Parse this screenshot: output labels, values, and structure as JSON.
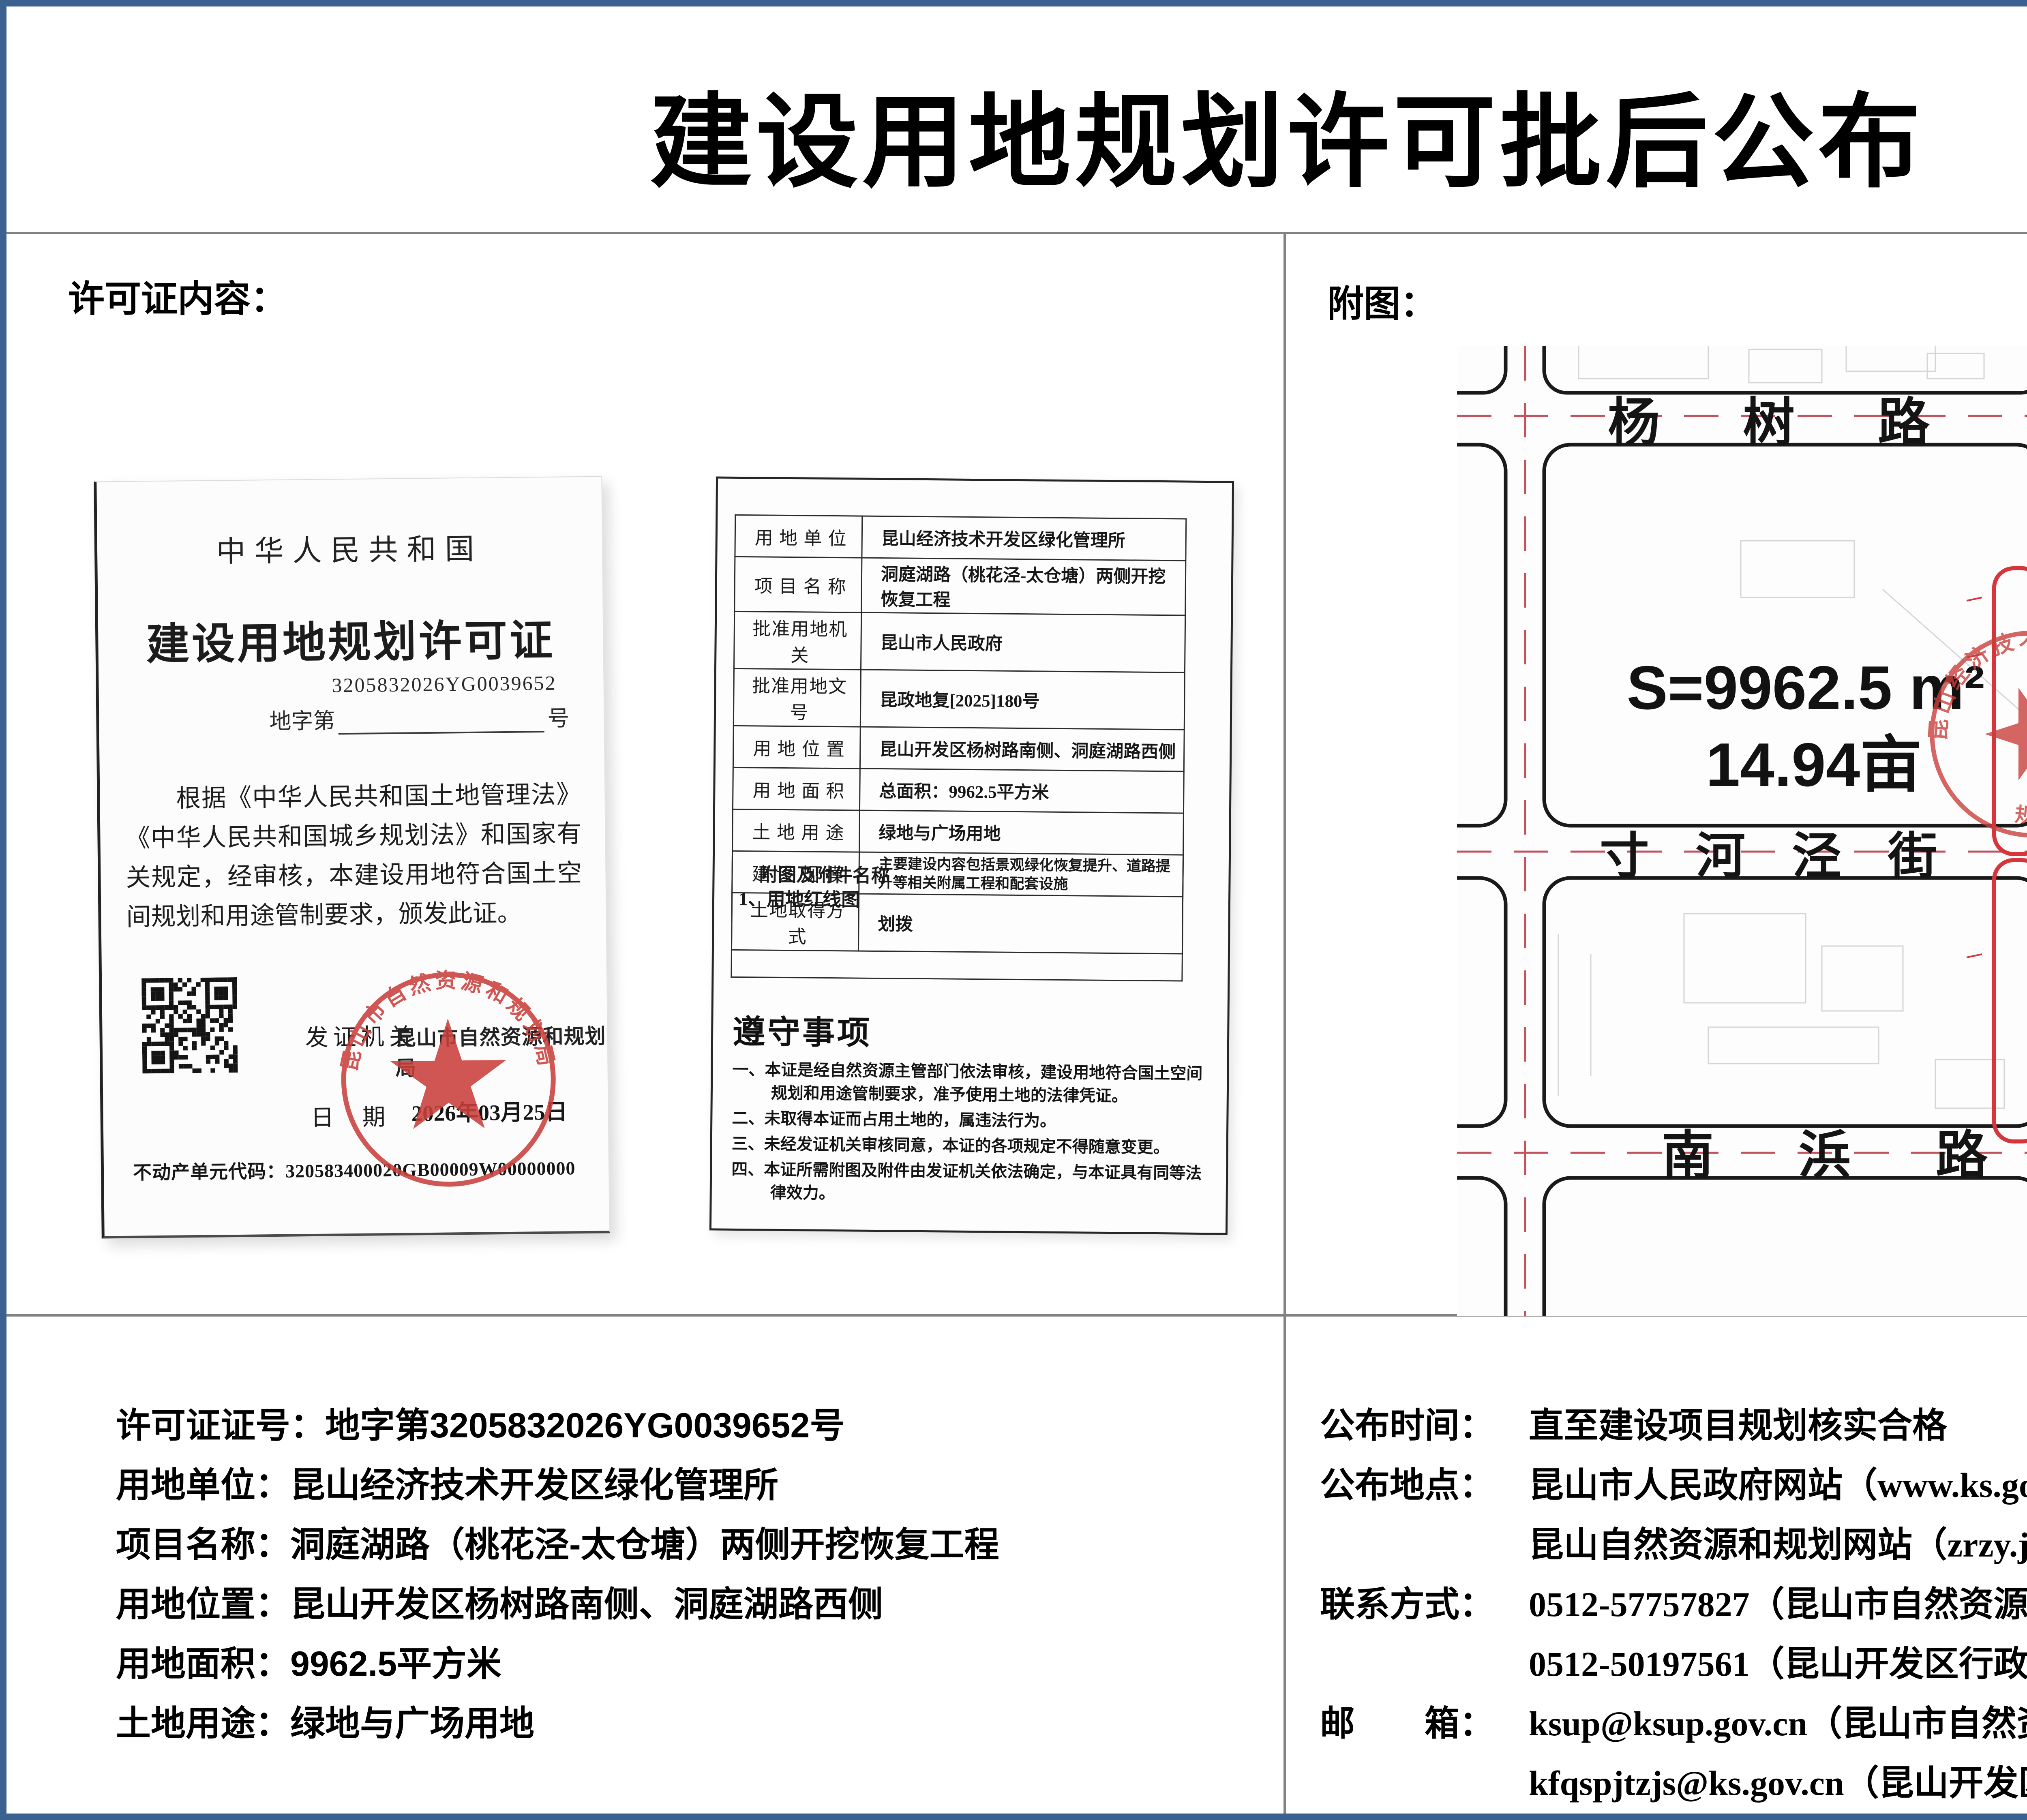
{
  "page": {
    "title": "建设用地规划许可批后公布",
    "doc_number": "昆开审布〔2026〕23号"
  },
  "left_section": {
    "heading": "许可证内容：",
    "certificate": {
      "country": "中华人民共和国",
      "cert_title": "建设用地规划许可证",
      "cert_serial": "3205832026YG0039652",
      "serial_prefix": "地字第",
      "serial_suffix": "号",
      "body": "根据《中华人民共和国土地管理法》《中华人民共和国城乡规划法》和国家有关规定，经审核，本建设用地符合国土空间规划和用途管制要求，颁发此证。",
      "issuer_label": "发证机关",
      "issuer": "昆山市自然资源和规划局",
      "date_label": "日期",
      "date": "2026年03月25日",
      "estate_code_label": "不动产单元代码：",
      "estate_code": "320583400020GB00009W00000000",
      "seal_text": "昆山市自然资源和规划局",
      "icons": {
        "qr": "qr-code",
        "seal": "official-seal"
      }
    }
  },
  "detail_table": {
    "rows": [
      {
        "label": "用 地 单 位",
        "value": "昆山经济技术开发区绿化管理所"
      },
      {
        "label": "项 目 名 称",
        "value": "洞庭湖路（桃花泾-太仓塘）两侧开挖恢复工程"
      },
      {
        "label": "批准用地机关",
        "value": "昆山市人民政府"
      },
      {
        "label": "批准用地文号",
        "value": "昆政地复[2025]180号"
      },
      {
        "label": "用 地 位 置",
        "value": "昆山开发区杨树路南侧、洞庭湖路西侧"
      },
      {
        "label": "用 地 面 积",
        "value": "总面积：9962.5平方米"
      },
      {
        "label": "土 地 用 途",
        "value": "绿地与广场用地"
      },
      {
        "label": "建 设 规 模",
        "value": "主要建设内容包括景观绿化恢复提升、道路提升等相关附属工程和配套设施"
      },
      {
        "label": "土地取得方式",
        "value": "划拨"
      }
    ],
    "attachment_label": "附图及附件名称",
    "attachment_item": "1、用地红线图",
    "notice_title": "遵守事项",
    "notice_items": [
      "一、本证是经自然资源主管部门依法审核，建设用地符合国土空间规划和用途管制要求，准予使用土地的法律凭证。",
      "二、未取得本证而占用土地的，属违法行为。",
      "三、未经发证机关审核同意，本证的各项规定不得随意变更。",
      "四、本证所需附图及附件由发证机关依法确定，与本证具有同等法律效力。"
    ]
  },
  "right_section": {
    "heading": "附图：",
    "map": {
      "roads": {
        "north": "杨树路",
        "middle": "寸河泾街",
        "south": "南浜路",
        "east_vertical": "洞庭湖路"
      },
      "area_sqm": "S=9962.5 m²",
      "area_mu": "14.94亩",
      "seal_text_top": "昆山经济技术开发区",
      "seal_text_bottom": "规划建设",
      "colors": {
        "road_line": "#1a1a1a",
        "parcel_red": "#d6353b",
        "centerline_red": "#c4515e",
        "canal_blue": "#2aa3c6",
        "seal_red": "#c9403c"
      }
    }
  },
  "bottom_left": {
    "lines": [
      {
        "label": "许可证证号：",
        "value": "地字第3205832026YG0039652号"
      },
      {
        "label": "用地单位：",
        "value": "昆山经济技术开发区绿化管理所"
      },
      {
        "label": "项目名称：",
        "value": "洞庭湖路（桃花泾-太仓塘）两侧开挖恢复工程"
      },
      {
        "label": "用地位置：",
        "value": "昆山开发区杨树路南侧、洞庭湖路西侧"
      },
      {
        "label": "用地面积：",
        "value": "9962.5平方米"
      },
      {
        "label": "土地用途：",
        "value": "绿地与广场用地"
      }
    ]
  },
  "bottom_right": {
    "lines": [
      {
        "label": "公布时间：",
        "value": "直至建设项目规划核实合格"
      },
      {
        "label": "公布地点：",
        "value": "昆山市人民政府网站（www.ks.gov.cn）"
      },
      {
        "label": "",
        "value": "昆山自然资源和规划网站（zrzy.jiangsu.gov.cn/szks）"
      },
      {
        "label": "联系方式：",
        "value": "0512-57757827（昆山市自然资源和规划局）"
      },
      {
        "label": "",
        "value": "0512-50197561（昆山开发区行政审批局）"
      },
      {
        "label": "邮　　箱：",
        "value": "ksup@ksup.gov.cn（昆山市自然资源和规划局）"
      },
      {
        "label": "",
        "value": "kfqspjtzjs@ks.gov.cn（昆山开发区行政审批局）"
      }
    ]
  }
}
